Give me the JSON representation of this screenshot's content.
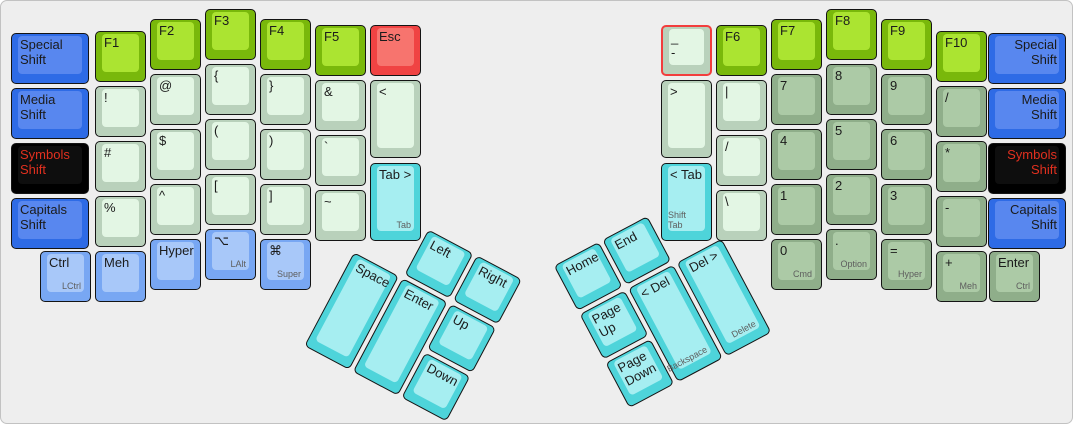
{
  "app": {
    "description": "ErgoDox split keyboard layout",
    "selection_color": "#f23d3d",
    "canvas_bg": "#eeeeee"
  },
  "palette": {
    "shift_blue": "#2e6be6",
    "modifier_light_blue": "#78a7f3",
    "function_green": "#79b80b",
    "symbol_pale_green": "#e3f6e4",
    "numpad_sage_green": "#accaa6",
    "thumb_cyan": "#4ed4da",
    "escape_red": "#f04343",
    "symbols_shift_black": "#000000",
    "symbols_shift_text_red": "#e1301f"
  },
  "keys": [
    {
      "n": "special-shift-left",
      "x": 8,
      "y": 30,
      "w": 82,
      "c": "blue",
      "l": "Special\nShift"
    },
    {
      "n": "media-shift-left",
      "x": 8,
      "y": 85,
      "w": 82,
      "c": "blue",
      "l": "Media\nShift"
    },
    {
      "n": "symbols-shift-left",
      "x": 8,
      "y": 140,
      "w": 82,
      "c": "black",
      "l": "Symbols\nShift"
    },
    {
      "n": "capitals-shift-left",
      "x": 8,
      "y": 195,
      "w": 82,
      "c": "blue",
      "l": "Capitals\nShift"
    },
    {
      "n": "f1",
      "x": 92,
      "y": 28,
      "c": "green",
      "l": "F1"
    },
    {
      "n": "exclamation",
      "x": 92,
      "y": 83,
      "c": "pale",
      "l": "!"
    },
    {
      "n": "hash",
      "x": 92,
      "y": 138,
      "c": "pale",
      "l": "#"
    },
    {
      "n": "percent",
      "x": 92,
      "y": 193,
      "c": "pale",
      "l": "%"
    },
    {
      "n": "f2",
      "x": 147,
      "y": 16,
      "c": "green",
      "l": "F2"
    },
    {
      "n": "at",
      "x": 147,
      "y": 71,
      "c": "pale",
      "l": "@"
    },
    {
      "n": "dollar",
      "x": 147,
      "y": 126,
      "c": "pale",
      "l": "$"
    },
    {
      "n": "caret",
      "x": 147,
      "y": 181,
      "c": "pale",
      "l": "^"
    },
    {
      "n": "hyper-left",
      "x": 147,
      "y": 236,
      "c": "lblue",
      "l": "Hyper"
    },
    {
      "n": "f3",
      "x": 202,
      "y": 6,
      "c": "green",
      "l": "F3"
    },
    {
      "n": "left-brace",
      "x": 202,
      "y": 61,
      "c": "pale",
      "l": "{"
    },
    {
      "n": "left-paren",
      "x": 202,
      "y": 116,
      "c": "pale",
      "l": "("
    },
    {
      "n": "left-bracket",
      "x": 202,
      "y": 171,
      "c": "pale",
      "l": "["
    },
    {
      "n": "lalt",
      "x": 202,
      "y": 226,
      "c": "lblue",
      "l": "⌥",
      "s": "LAlt"
    },
    {
      "n": "f4",
      "x": 257,
      "y": 16,
      "c": "green",
      "l": "F4"
    },
    {
      "n": "right-brace",
      "x": 257,
      "y": 71,
      "c": "pale",
      "l": "}"
    },
    {
      "n": "right-paren",
      "x": 257,
      "y": 126,
      "c": "pale",
      "l": ")"
    },
    {
      "n": "right-bracket",
      "x": 257,
      "y": 181,
      "c": "pale",
      "l": "]"
    },
    {
      "n": "super",
      "x": 257,
      "y": 236,
      "c": "lblue",
      "l": "⌘",
      "s": "Super"
    },
    {
      "n": "f5",
      "x": 312,
      "y": 22,
      "c": "green",
      "l": "F5"
    },
    {
      "n": "ampersand",
      "x": 312,
      "y": 77,
      "c": "pale",
      "l": "&"
    },
    {
      "n": "backtick",
      "x": 312,
      "y": 132,
      "c": "pale",
      "l": "`"
    },
    {
      "n": "tilde",
      "x": 312,
      "y": 187,
      "c": "pale",
      "l": "~"
    },
    {
      "n": "esc",
      "x": 367,
      "y": 22,
      "c": "red",
      "l": "Esc"
    },
    {
      "n": "less-than",
      "x": 367,
      "y": 77,
      "h": 82,
      "c": "pale",
      "l": "<"
    },
    {
      "n": "tab",
      "x": 367,
      "y": 160,
      "h": 82,
      "c": "cyan",
      "l": "Tab >",
      "s": "Tab"
    },
    {
      "n": "ctrl-left",
      "x": 37,
      "y": 248,
      "c": "lblue",
      "l": "Ctrl",
      "s": "LCtrl"
    },
    {
      "n": "meh-left",
      "x": 92,
      "y": 248,
      "c": "lblue",
      "l": "Meh"
    },
    {
      "n": "minus-underscore",
      "x": 658,
      "y": 22,
      "c": "pale",
      "l": "_\n-",
      "sel": true
    },
    {
      "n": "greater-than",
      "x": 658,
      "y": 77,
      "h": 82,
      "c": "pale",
      "l": ">"
    },
    {
      "n": "shift-tab",
      "x": 658,
      "y": 160,
      "h": 82,
      "c": "cyan",
      "l": "< Tab",
      "s": "Shift Tab"
    },
    {
      "n": "f6",
      "x": 713,
      "y": 22,
      "c": "green",
      "l": "F6"
    },
    {
      "n": "pipe",
      "x": 713,
      "y": 77,
      "c": "pale",
      "l": "|"
    },
    {
      "n": "slash",
      "x": 713,
      "y": 132,
      "c": "pale",
      "l": "/"
    },
    {
      "n": "backslash",
      "x": 713,
      "y": 187,
      "c": "pale",
      "l": "\\"
    },
    {
      "n": "f7",
      "x": 768,
      "y": 16,
      "c": "green",
      "l": "F7"
    },
    {
      "n": "num-7",
      "x": 768,
      "y": 71,
      "c": "sage",
      "l": "7"
    },
    {
      "n": "num-4",
      "x": 768,
      "y": 126,
      "c": "sage",
      "l": "4"
    },
    {
      "n": "num-1",
      "x": 768,
      "y": 181,
      "c": "sage",
      "l": "1"
    },
    {
      "n": "num-0",
      "x": 768,
      "y": 236,
      "c": "sage",
      "l": "0",
      "s": "Cmd"
    },
    {
      "n": "f8",
      "x": 823,
      "y": 6,
      "c": "green",
      "l": "F8"
    },
    {
      "n": "num-8",
      "x": 823,
      "y": 61,
      "c": "sage",
      "l": "8"
    },
    {
      "n": "num-5",
      "x": 823,
      "y": 116,
      "c": "sage",
      "l": "5"
    },
    {
      "n": "num-2",
      "x": 823,
      "y": 171,
      "c": "sage",
      "l": "2"
    },
    {
      "n": "num-period",
      "x": 823,
      "y": 226,
      "c": "sage",
      "l": ".",
      "s": "Option"
    },
    {
      "n": "f9",
      "x": 878,
      "y": 16,
      "c": "green",
      "l": "F9"
    },
    {
      "n": "num-9",
      "x": 878,
      "y": 71,
      "c": "sage",
      "l": "9"
    },
    {
      "n": "num-6",
      "x": 878,
      "y": 126,
      "c": "sage",
      "l": "6"
    },
    {
      "n": "num-3",
      "x": 878,
      "y": 181,
      "c": "sage",
      "l": "3"
    },
    {
      "n": "num-equals",
      "x": 878,
      "y": 236,
      "c": "sage",
      "l": "=",
      "s": "Hyper"
    },
    {
      "n": "f10",
      "x": 933,
      "y": 28,
      "c": "green",
      "l": "F10"
    },
    {
      "n": "num-slash",
      "x": 933,
      "y": 83,
      "c": "sage",
      "l": "/"
    },
    {
      "n": "num-asterisk",
      "x": 933,
      "y": 138,
      "c": "sage",
      "l": "*"
    },
    {
      "n": "num-minus",
      "x": 933,
      "y": 193,
      "c": "sage",
      "l": "-"
    },
    {
      "n": "num-plus",
      "x": 933,
      "y": 248,
      "c": "sage",
      "l": "+",
      "s": "Meh"
    },
    {
      "n": "special-shift-right",
      "x": 985,
      "y": 30,
      "w": 82,
      "c": "blue",
      "l": "Special\nShift",
      "a": "r"
    },
    {
      "n": "media-shift-right",
      "x": 985,
      "y": 85,
      "w": 82,
      "c": "blue",
      "l": "Media\nShift",
      "a": "r"
    },
    {
      "n": "symbols-shift-right",
      "x": 985,
      "y": 140,
      "w": 82,
      "c": "black",
      "l": "Symbols\nShift",
      "a": "r"
    },
    {
      "n": "capitals-shift-right",
      "x": 985,
      "y": 195,
      "w": 82,
      "c": "blue",
      "l": "Capitals\nShift",
      "a": "r"
    },
    {
      "n": "enter-right",
      "x": 986,
      "y": 248,
      "c": "sage",
      "l": "Enter",
      "s": "Ctrl"
    },
    {
      "n": "thumb-left-arrow",
      "x": 55,
      "y": 0,
      "c": "cyan",
      "l": "Left",
      "r": 28,
      "ox": 378,
      "oy": 200
    },
    {
      "n": "thumb-right-arrow",
      "x": 110,
      "y": 0,
      "c": "cyan",
      "l": "Right",
      "r": 28,
      "ox": 378,
      "oy": 200
    },
    {
      "n": "thumb-space",
      "x": 0,
      "y": 55,
      "h": 110,
      "c": "cyan",
      "l": "Space",
      "r": 28,
      "ox": 378,
      "oy": 200
    },
    {
      "n": "thumb-enter",
      "x": 55,
      "y": 55,
      "h": 110,
      "c": "cyan",
      "l": "Enter",
      "r": 28,
      "ox": 378,
      "oy": 200
    },
    {
      "n": "thumb-up-arrow",
      "x": 110,
      "y": 55,
      "c": "cyan",
      "l": "Up",
      "r": 28,
      "ox": 378,
      "oy": 200
    },
    {
      "n": "thumb-down-arrow",
      "x": 110,
      "y": 110,
      "c": "cyan",
      "l": "Down",
      "r": 28,
      "ox": 378,
      "oy": 200
    },
    {
      "n": "thumb-home",
      "x": 0,
      "y": 0,
      "c": "cyan",
      "l": "Home",
      "r": -28,
      "ox": 550,
      "oy": 264
    },
    {
      "n": "thumb-end",
      "x": 55,
      "y": 0,
      "c": "cyan",
      "l": "End",
      "r": -28,
      "ox": 550,
      "oy": 264
    },
    {
      "n": "thumb-page-up",
      "x": 0,
      "y": 55,
      "c": "cyan",
      "l": "Page\nUp",
      "r": -28,
      "ox": 550,
      "oy": 264
    },
    {
      "n": "thumb-backspace",
      "x": 55,
      "y": 55,
      "h": 110,
      "c": "cyan",
      "l": "< Del",
      "s": "Backspace",
      "r": -28,
      "ox": 550,
      "oy": 264
    },
    {
      "n": "thumb-delete",
      "x": 110,
      "y": 55,
      "h": 110,
      "c": "cyan",
      "l": "Del >",
      "s": "Delete",
      "r": -28,
      "ox": 550,
      "oy": 264
    },
    {
      "n": "thumb-page-down",
      "x": 0,
      "y": 110,
      "c": "cyan",
      "l": "Page\nDown",
      "r": -28,
      "ox": 550,
      "oy": 264
    }
  ]
}
